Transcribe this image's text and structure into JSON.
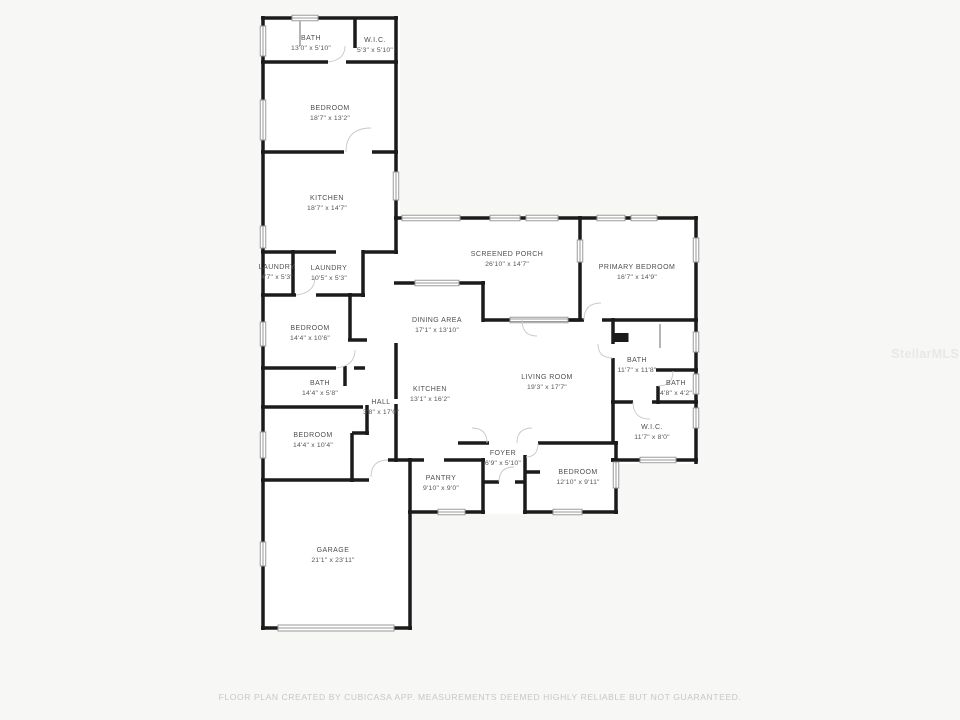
{
  "watermark": "StellarMLS",
  "footer": "FLOOR PLAN CREATED BY CUBICASA APP. MEASUREMENTS DEEMED HIGHLY RELIABLE BUT NOT GUARANTEED.",
  "colors": {
    "wall": "#1b1b1b",
    "window_outline": "#9a9a9a",
    "door_arc": "#c9c9c9",
    "label_text": "#4f4f4f",
    "footer_text": "#c7c7c7",
    "watermark_text": "#e8e8e8",
    "room_fill": "#ffffff",
    "background": "#f7f7f6"
  },
  "rooms": [
    {
      "name": "BATH",
      "dims": "13'0\" x 5'10\""
    },
    {
      "name": "W.I.C.",
      "dims": "5'3\" x 5'10\""
    },
    {
      "name": "BEDROOM",
      "dims": "18'7\" x 13'2\""
    },
    {
      "name": "KITCHEN",
      "dims": "18'7\" x 14'7\""
    },
    {
      "name": "LAUNDRY",
      "dims": "4'7\" x 5'3\""
    },
    {
      "name": "LAUNDRY",
      "dims": "10'5\" x 5'3\""
    },
    {
      "name": "BEDROOM",
      "dims": "14'4\" x 10'6\""
    },
    {
      "name": "BATH",
      "dims": "14'4\" x 5'8\""
    },
    {
      "name": "HALL",
      "dims": "3'8\" x 17'0\""
    },
    {
      "name": "BEDROOM",
      "dims": "14'4\" x 10'4\""
    },
    {
      "name": "GARAGE",
      "dims": "21'1\" x 23'11\""
    },
    {
      "name": "SCREENED PORCH",
      "dims": "26'10\" x 14'7\""
    },
    {
      "name": "DINING AREA",
      "dims": "17'1\" x 13'10\""
    },
    {
      "name": "KITCHEN",
      "dims": "13'1\" x 16'2\""
    },
    {
      "name": "LIVING ROOM",
      "dims": "19'3\" x 17'7\""
    },
    {
      "name": "PRIMARY BEDROOM",
      "dims": "16'7\" x 14'9\""
    },
    {
      "name": "BATH",
      "dims": "11'7\" x 11'8\""
    },
    {
      "name": "BATH",
      "dims": "4'8\" x 4'2\""
    },
    {
      "name": "W.I.C.",
      "dims": "11'7\" x 8'0\""
    },
    {
      "name": "FOYER",
      "dims": "6'9\" x 5'10\""
    },
    {
      "name": "PANTRY",
      "dims": "9'10\" x 9'0\""
    },
    {
      "name": "BEDROOM",
      "dims": "12'10\" x 9'11\""
    }
  ]
}
